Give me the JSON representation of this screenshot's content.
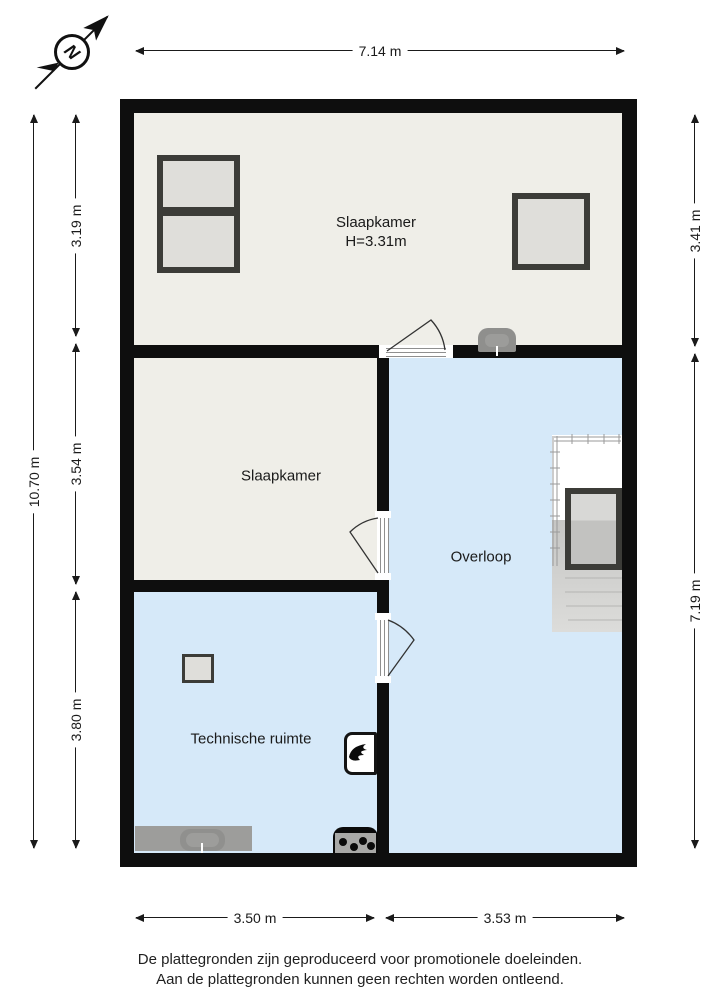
{
  "compass": {
    "letter": "N"
  },
  "dimensions": {
    "top": "7.14 m",
    "left_total": "10.70 m",
    "left": [
      "3.19 m",
      "3.54 m",
      "3.80 m"
    ],
    "right": [
      "3.41 m",
      "7.19 m"
    ],
    "bottom": [
      "3.50 m",
      "3.53 m"
    ]
  },
  "rooms": {
    "slaapkamer1": {
      "label": "Slaapkamer",
      "height_label": "H=3.31m"
    },
    "slaapkamer2": {
      "label": "Slaapkamer"
    },
    "overloop": {
      "label": "Overloop"
    },
    "technische_ruimte": {
      "label": "Technische ruimte"
    }
  },
  "footer": {
    "line1": "De plattegronden zijn geproduceerd voor promotionele doeleinden.",
    "line2": "Aan de plattegronden kunnen geen rechten worden ontleend."
  },
  "colors": {
    "wall": "#0e0e0e",
    "room_cream": "#EFEEE8",
    "room_blue": "#D6E9F9",
    "window_frame": "#3C3C38",
    "window_glass": "#DFDEDA",
    "fixture_gray": "#9D9D9B",
    "stairs_gray": "#C6C6C4",
    "dimension_line": "#1a1a1a"
  }
}
